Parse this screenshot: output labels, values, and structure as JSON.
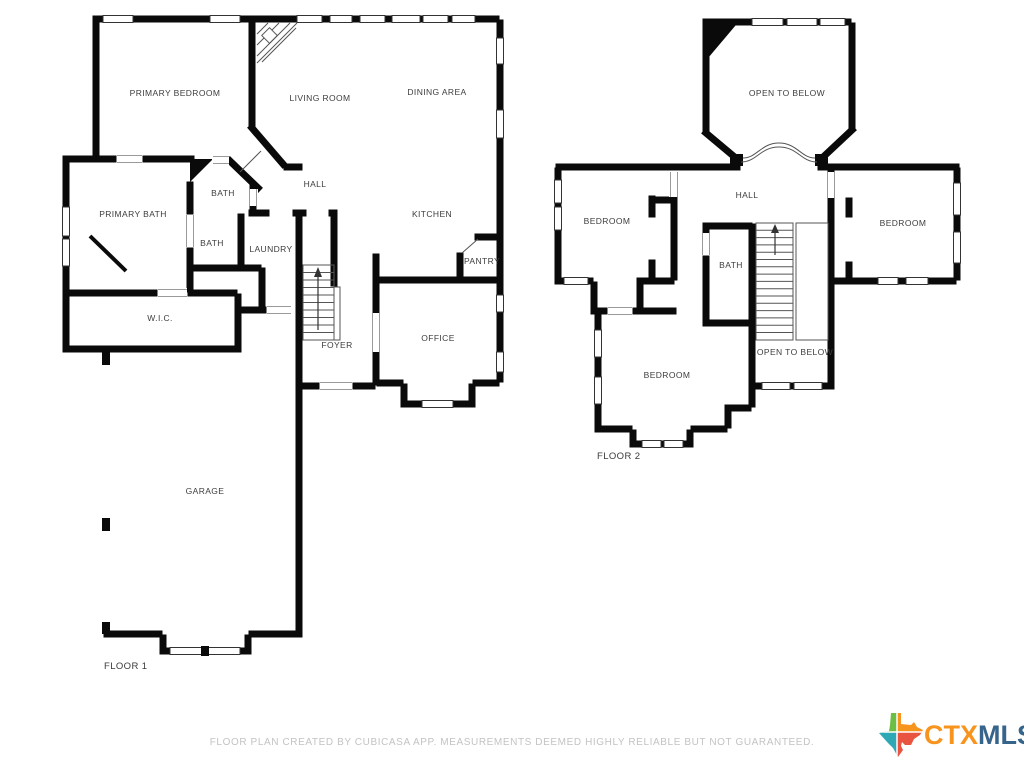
{
  "page": {
    "background": "#ffffff",
    "type": "floor-plan"
  },
  "floor1": {
    "label": "FLOOR 1",
    "rooms": [
      {
        "name": "primary-bedroom",
        "label": "PRIMARY BEDROOM",
        "x": 175,
        "y": 93
      },
      {
        "name": "living-room",
        "label": "LIVING ROOM",
        "x": 320,
        "y": 98
      },
      {
        "name": "dining-area",
        "label": "DINING AREA",
        "x": 437,
        "y": 92
      },
      {
        "name": "bath-upper",
        "label": "BATH",
        "x": 223,
        "y": 193
      },
      {
        "name": "hall",
        "label": "HALL",
        "x": 315,
        "y": 184
      },
      {
        "name": "kitchen",
        "label": "KITCHEN",
        "x": 432,
        "y": 214
      },
      {
        "name": "primary-bath",
        "label": "PRIMARY BATH",
        "x": 133,
        "y": 214
      },
      {
        "name": "bath-lower",
        "label": "BATH",
        "x": 212,
        "y": 243
      },
      {
        "name": "laundry",
        "label": "LAUNDRY",
        "x": 271,
        "y": 249
      },
      {
        "name": "pantry",
        "label": "PANTRY",
        "x": 482,
        "y": 261
      },
      {
        "name": "wic",
        "label": "W.I.C.",
        "x": 160,
        "y": 318
      },
      {
        "name": "foyer",
        "label": "FOYER",
        "x": 337,
        "y": 345
      },
      {
        "name": "office",
        "label": "OFFICE",
        "x": 438,
        "y": 338
      },
      {
        "name": "garage",
        "label": "GARAGE",
        "x": 205,
        "y": 491
      }
    ]
  },
  "floor2": {
    "label": "FLOOR 2",
    "rooms": [
      {
        "name": "open-to-below-top",
        "label": "OPEN TO BELOW",
        "x": 787,
        "y": 93
      },
      {
        "name": "hall",
        "label": "HALL",
        "x": 747,
        "y": 195
      },
      {
        "name": "bedroom-left",
        "label": "BEDROOM",
        "x": 607,
        "y": 221
      },
      {
        "name": "bedroom-right",
        "label": "BEDROOM",
        "x": 903,
        "y": 223
      },
      {
        "name": "bath",
        "label": "BATH",
        "x": 731,
        "y": 265
      },
      {
        "name": "bedroom-bottom",
        "label": "BEDROOM",
        "x": 667,
        "y": 375
      },
      {
        "name": "open-to-below-stairs",
        "label": "OPEN TO BELOW",
        "x": 795,
        "y": 352
      }
    ]
  },
  "footer": {
    "disclaimer": "FLOOR PLAN CREATED BY CUBICASA APP. MEASUREMENTS DEEMED HIGHLY RELIABLE BUT NOT GUARANTEED."
  },
  "logo": {
    "ctx": "CTX",
    "mls": "MLS",
    "icon": "texas-state-icon"
  },
  "colors": {
    "wall": "#0a0a0a",
    "room_label_text": "#3d3d3d",
    "disclaimer_text": "#c3c3c3",
    "logo_orange": "#F7941E",
    "logo_blue": "#36648B",
    "texas_green": "#6CBE45",
    "texas_orange": "#F7941E",
    "texas_teal": "#2FA8B5",
    "texas_red": "#E8543F"
  }
}
